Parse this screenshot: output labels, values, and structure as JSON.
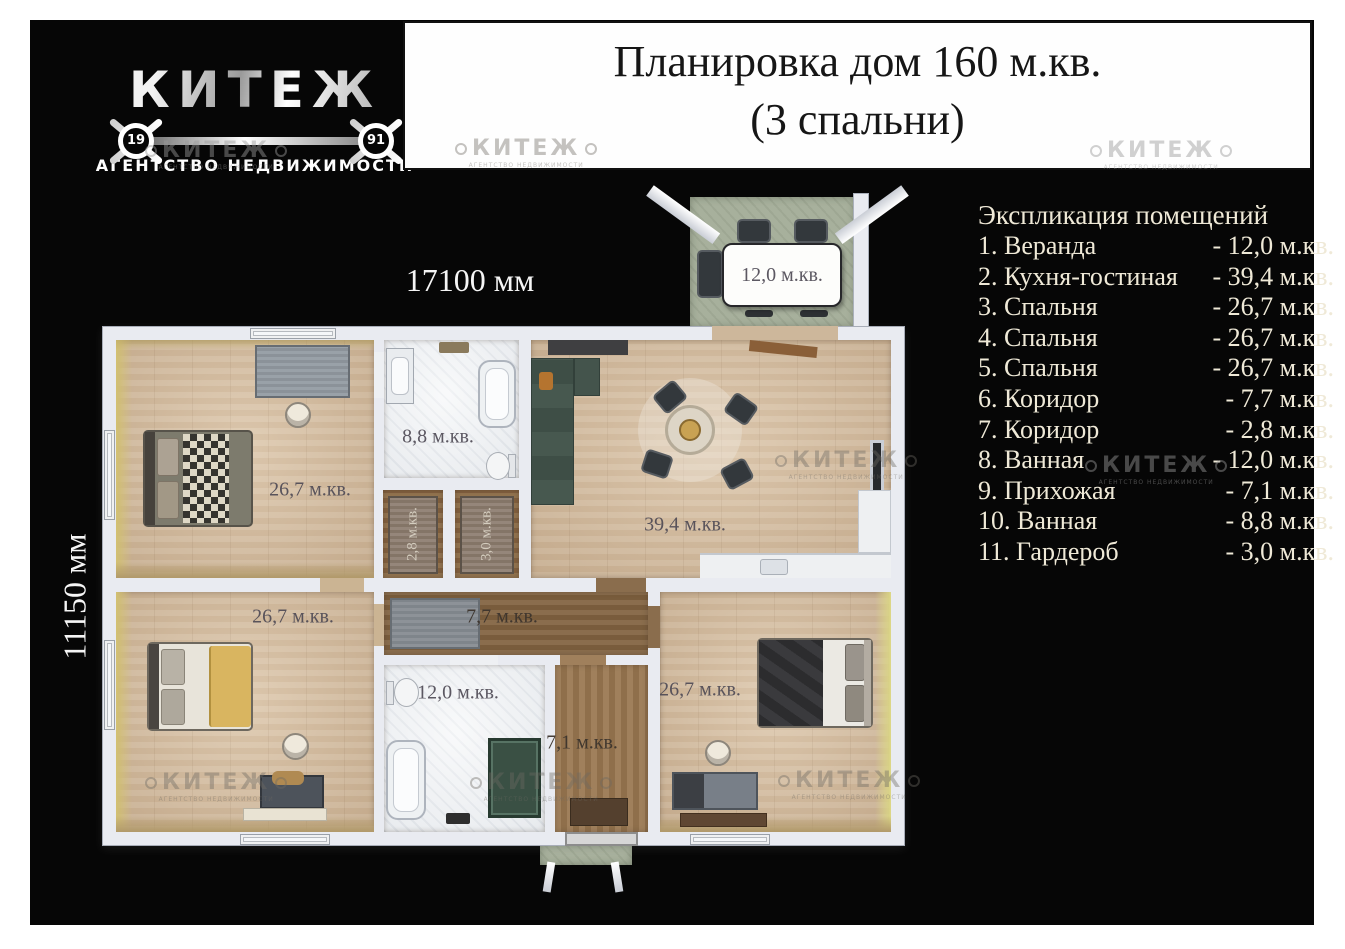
{
  "logo": {
    "brand": "КИТЕЖ",
    "year_left": "19",
    "year_right": "91",
    "tagline": "АГЕНТСТВО НЕДВИЖИМОСТИ"
  },
  "title": {
    "line1": "Планировка дом 160 м.кв.",
    "line2": "(3 спальни)"
  },
  "dimensions": {
    "width": "17100 мм",
    "height": "11150 мм"
  },
  "legend": {
    "heading": "Экспликация помещений",
    "items": [
      {
        "label": "1. Веранда",
        "area": "- 12,0 м.кв."
      },
      {
        "label": "2. Кухня-гостиная",
        "area": "- 39,4 м.кв."
      },
      {
        "label": "3. Спальня",
        "area": "- 26,7 м.кв."
      },
      {
        "label": "4. Спальня",
        "area": "- 26,7 м.кв."
      },
      {
        "label": "5. Спальня",
        "area": "- 26,7 м.кв."
      },
      {
        "label": "6. Коридор",
        "area": "- 7,7 м.кв."
      },
      {
        "label": "7. Коридор",
        "area": "- 2,8 м.кв."
      },
      {
        "label": "8. Ванная",
        "area": "- 12,0 м.кв."
      },
      {
        "label": "9. Прихожая",
        "area": "- 7,1 м.кв."
      },
      {
        "label": "10. Ванная",
        "area": "- 8,8 м.кв."
      },
      {
        "label": "11. Гардероб",
        "area": "- 3,0 м.кв."
      }
    ]
  },
  "plan_labels": {
    "veranda": "12,0 м.кв.",
    "bedroom_top_left": "26,7 м.кв.",
    "bath_top": "8,8 м.кв.",
    "corridor_small": "2,8 м.кв.",
    "wardrobe": "3,0 м.кв.",
    "kitchen_living": "39,4 м.кв.",
    "bedroom_bottom_left": "26,7 м.кв.",
    "corridor": "7,7 м.кв.",
    "bath_bottom": "12,0 м.кв.",
    "hallway": "7,1 м.кв.",
    "bedroom_bottom_right": "26,7 м.кв."
  },
  "watermark": {
    "text": "КИТЕЖ",
    "subtext": "АГЕНТСТВО НЕДВИЖИМОСТИ"
  },
  "colors": {
    "canvas": "#060606",
    "legend_text": "#efe9d7",
    "wall": "#e9ebf1",
    "wood_floor": "#d5bd9f",
    "marble_floor": "#f2f4f6",
    "dark_floor": "#8a6d4d",
    "veranda_floor": "#a7b09c"
  }
}
